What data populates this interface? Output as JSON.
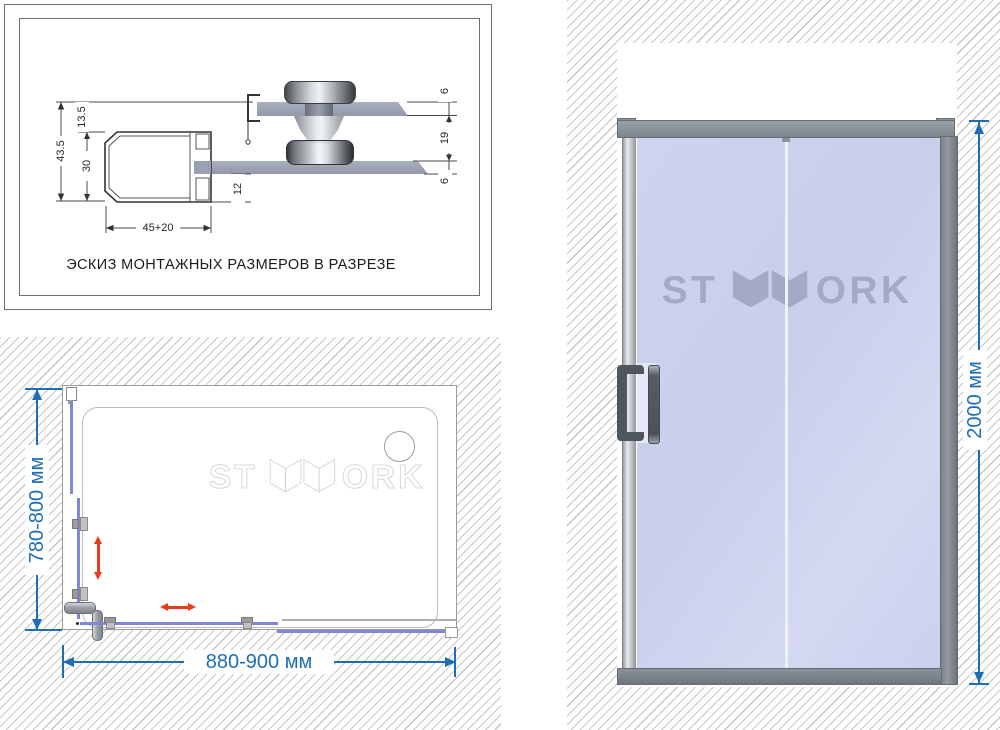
{
  "sketch": {
    "title": "ЭСКИЗ МОНТАЖНЫХ РАЗМЕРОВ В РАЗРЕЗЕ",
    "dim_overall_height": "43.5",
    "dim_top_offset": "13.5",
    "dim_profile_height": "30",
    "dim_profile_width": "45+20",
    "dim_glass_inset": "12",
    "dim_upper_glass_thickness": "6",
    "dim_roller_gap": "19",
    "dim_lower_glass_thickness": "6"
  },
  "plan_view": {
    "width_label": "880-900 мм",
    "depth_label": "780-800 мм",
    "brand_prefix": "ST",
    "brand_suffix": "ORKI"
  },
  "front_view": {
    "height_label": "2000 мм",
    "brand_prefix": "ST",
    "brand_suffix": "ORKI"
  },
  "colors": {
    "dimension_blue": "#1d6eb5",
    "door_glass": "#cdd3ee",
    "plan_glass_line": "#8187d6",
    "direction_arrow_red": "#e83c1e",
    "frame_gray": "#868d94",
    "watermark_gray": "#a4a9c4",
    "hatch_gray": "#c6c6c6"
  }
}
